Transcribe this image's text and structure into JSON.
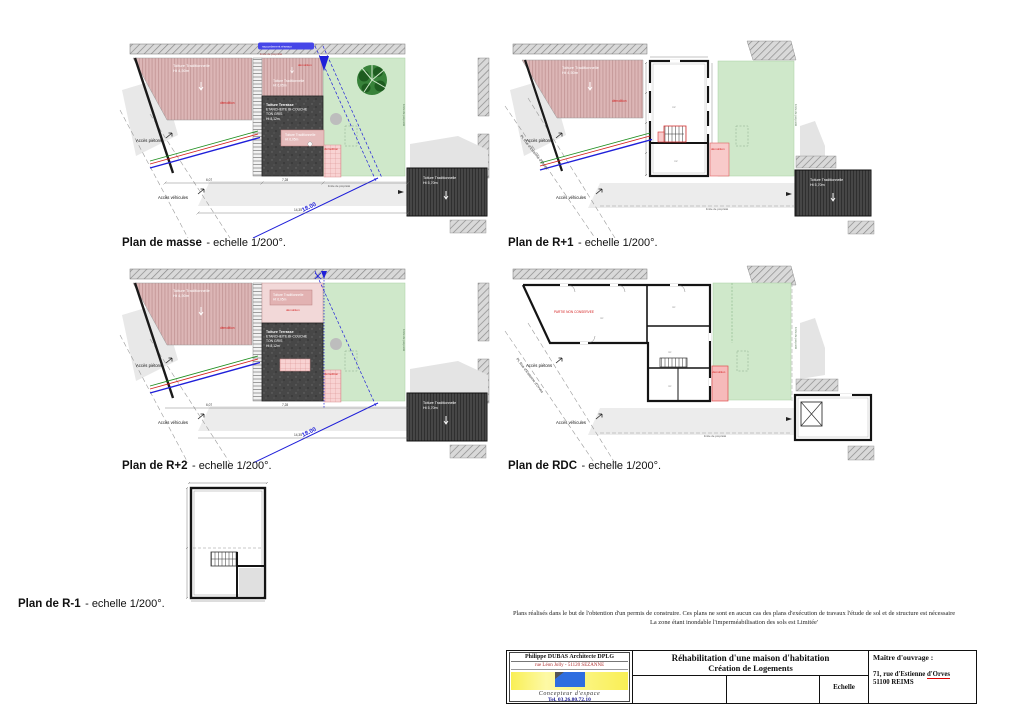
{
  "sheet": {
    "captions": {
      "masse": {
        "title": "Plan de masse",
        "suffix": "- echelle 1/200°."
      },
      "r1": {
        "title": "Plan de R+1",
        "suffix": "- echelle 1/200°."
      },
      "r2": {
        "title": "Plan de R+2",
        "suffix": "- echelle 1/200°."
      },
      "rdc": {
        "title": "Plan de RDC",
        "suffix": "- echelle 1/200°."
      },
      "rm1": {
        "title": "Plan de R-1",
        "suffix": "- echelle 1/200°."
      }
    },
    "labels": {
      "acces_pietons": "Accès piétons",
      "acces_vehicules": "Accès véhicules",
      "street": "PL Rue d'Estienne d'Orves",
      "toiture_trad": "Toiture Traditionnelle",
      "ht_roof": "Ht 4,50m",
      "ht_annexe": "Ht 6,05m",
      "ht_garage": "Ht 5,70m",
      "terrasse1": "Toiture Terrasse",
      "terrasse2": "ETANCHEITE BI-COUCHE",
      "terrasse3": "TON GRIS",
      "terrasse4": "Ht 8,12m",
      "demolition": "démolition",
      "rdc_red": "PARTIE NON CONSERVEE",
      "dim18": "18.00",
      "limite": "limite de propriété",
      "reseaux": "raccordement réseaux",
      "dim_607": "6,07",
      "dim_728": "7,28",
      "dim_1435": "14,35",
      "m2": "m²"
    },
    "disclaimer": {
      "line1": "Plans réalisés dans le but de l'obtention d'un permis de construire. Ces plans ne sont en aucun cas des plans d'exécution de travaux l'étude de sol et de structure est  nécessaire",
      "line2": "La zone étant inondable l'imperméabilisation  des sols est  Limitée'"
    },
    "titleblock": {
      "architect_name": "Philippe DUBAS Architecte DPLG",
      "architect_addr": "rue Léon Jolly - 51120 SEZANNE",
      "architect_tagline": "Concepteur d'espace",
      "architect_tel": "Tel. 03.26.80.72.10",
      "project_line1": "Réhabilitation d'une maison d'habitation",
      "project_line2": "Création de Logements",
      "echelle_label": "Echelle",
      "owner_label": "Maître d'ouvrage :",
      "owner_addr1a": "71, rue d'Estienne  ",
      "owner_addr1b": "d'Orves",
      "owner_addr2": "51100 REIMS"
    },
    "colors": {
      "pink_roof": "#dcb6b6",
      "dark_roof": "#474747",
      "garden": "#cfe8ca",
      "demol_pink": "#f8caca",
      "blue": "#1f1fd9",
      "red": "#d42020",
      "green_line": "#1f8f1f"
    }
  }
}
